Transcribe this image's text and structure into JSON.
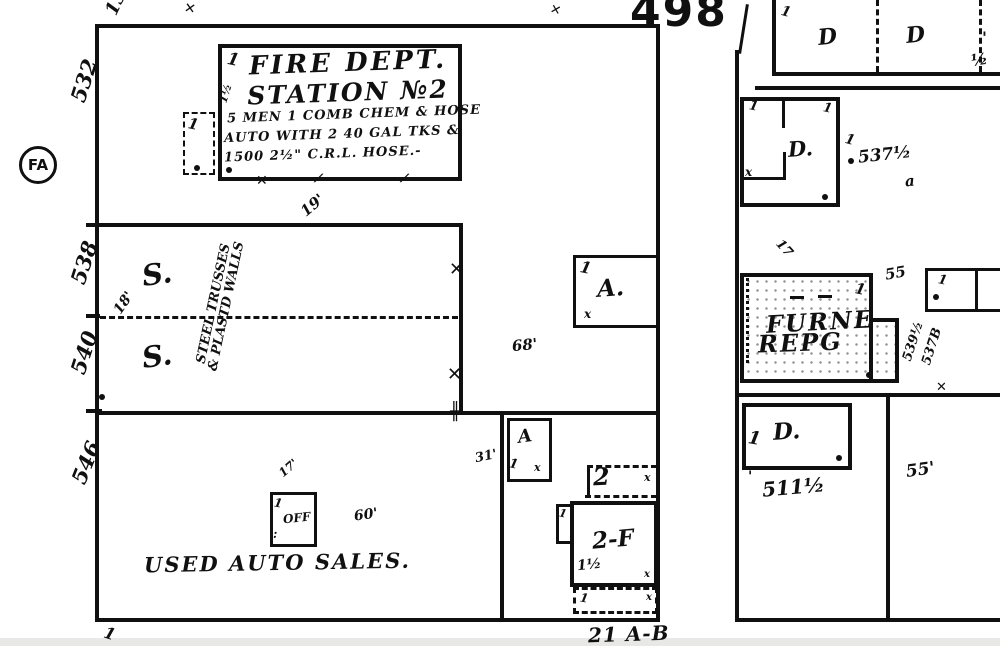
{
  "plate": {
    "number": "498",
    "top_number": "13",
    "block_ref": "21 A-B",
    "fa": "FA"
  },
  "streets": {
    "n532": "532",
    "n538": "538",
    "n540": "540",
    "n546": "546"
  },
  "fire": {
    "story": "1",
    "side": "1½",
    "annex_story": "1",
    "t1": "FIRE DEPT.",
    "t2": "STATION №2",
    "d1": "5 MEN 1 COMB CHEM & HOSE",
    "d2": "AUTO WITH 2 40 GAL TKS &",
    "d3": "1500 2½\" C.R.L. HOSE.-"
  },
  "ware": {
    "s": "S.",
    "note1": "STEEL TRUSSES",
    "note2": "& PLASTD WALLS",
    "d18": "18'",
    "d19": "19'",
    "d68": "68'",
    "a": "A.",
    "a_story": "1",
    "a_x": "x"
  },
  "lot": {
    "label": "USED AUTO SALES.",
    "off": "OFF",
    "off_story": "1",
    "off_dots": ":",
    "d17": "17'",
    "d60": "60'",
    "corner_tick": "1"
  },
  "south": {
    "a": "A",
    "a_story": "1",
    "a_x": "x",
    "d31": "31'",
    "two": "2",
    "two_x": "x",
    "twof": "2-F",
    "oneh": "1½",
    "notch_story": "1",
    "base_story": "1",
    "base_x": "x"
  },
  "right": {
    "d1": "D",
    "d2": "D",
    "top_story": "1",
    "half": "½",
    "tick": "'",
    "du": "D.",
    "du_x": "x",
    "du_s1": "1",
    "du_s2": "1",
    "n537": "537½",
    "small_a": "a",
    "n17": "17",
    "furne1": "FURNE",
    "furne2": "REPG",
    "f_story": "1",
    "n55": "55",
    "n539": "539½",
    "n537b": "537B",
    "box_story": "1",
    "dl": "D.",
    "dl_story": "1",
    "n511": "511½",
    "d55": "55'"
  },
  "marks": {
    "x": "✕",
    "hm": "╫",
    "dot": "•",
    "slash": "/"
  }
}
